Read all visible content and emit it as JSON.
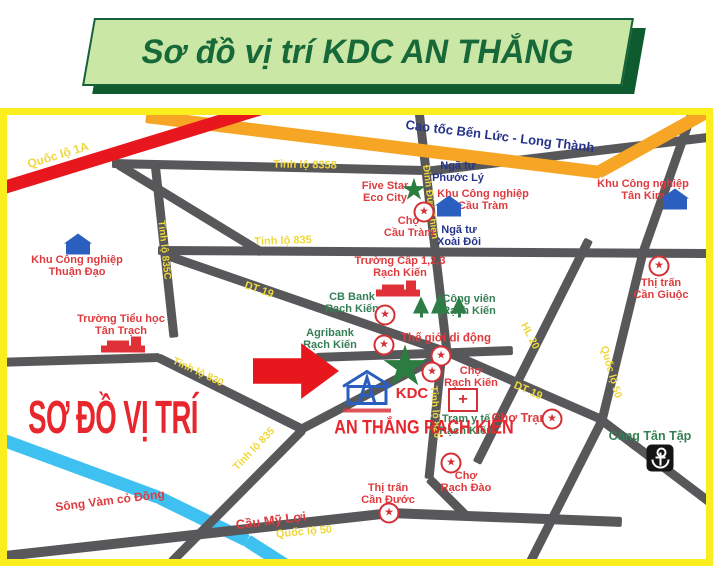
{
  "banner": {
    "title": "Sơ đồ vị trí KDC AN THẮNG"
  },
  "palette": {
    "gray": "#58585A",
    "orange": "#F6A624",
    "red": "#E8161D",
    "river": "#3EC1F0",
    "yellow": "#EFD83C",
    "navy": "#26348B",
    "poired": "#DF3B3E",
    "poigreen": "#357F55",
    "kdcred": "#E8262D",
    "frame_yellow": "#FAEE1E",
    "banner_green": "#CBE7A5",
    "banner_dark": "#0E5B30"
  },
  "map": {
    "watermark": "SƠ ĐỒ VỊ TRÍ",
    "river_segments": [
      {
        "id": "song-vam-co-dong-1",
        "x1": -4,
        "y1": 437,
        "x2": 159,
        "y2": 497,
        "w": 13,
        "c": "river"
      },
      {
        "id": "song-vam-co-dong-2",
        "x1": 159,
        "y1": 497,
        "x2": 247,
        "y2": 540,
        "w": 13,
        "c": "river"
      },
      {
        "id": "song-vam-co-dong-3",
        "x1": 247,
        "y1": 540,
        "x2": 294,
        "y2": 570,
        "w": 13,
        "c": "river"
      }
    ],
    "road_segments": [
      {
        "id": "tinh-lo-8358-w",
        "x1": 112,
        "y1": 163,
        "x2": 427,
        "y2": 170,
        "w": 9,
        "c": "gray"
      },
      {
        "id": "tinh-lo-8358-e",
        "x1": 425,
        "y1": 171,
        "x2": 716,
        "y2": 136,
        "w": 9,
        "c": "gray"
      },
      {
        "id": "nhanh-ql1a",
        "x1": 118,
        "y1": 164,
        "x2": 262,
        "y2": 252,
        "w": 9,
        "c": "gray"
      },
      {
        "id": "tinh-lo-835c",
        "x1": 155,
        "y1": 162,
        "x2": 174,
        "y2": 337,
        "w": 9,
        "c": "gray"
      },
      {
        "id": "tinh-lo-835",
        "x1": 158,
        "y1": 250,
        "x2": 716,
        "y2": 253,
        "w": 9,
        "c": "gray"
      },
      {
        "id": "dinh-duc-thien",
        "x1": 419,
        "y1": 110,
        "x2": 447,
        "y2": 352,
        "w": 9,
        "c": "gray"
      },
      {
        "id": "tinh-lo-830-w",
        "x1": -4,
        "y1": 362,
        "x2": 160,
        "y2": 357,
        "w": 9,
        "c": "gray"
      },
      {
        "id": "tinh-lo-830-e",
        "x1": 158,
        "y1": 357,
        "x2": 303,
        "y2": 429,
        "w": 9,
        "c": "gray"
      },
      {
        "id": "tinh-lo-835-sw",
        "x1": 303,
        "y1": 429,
        "x2": 171,
        "y2": 562,
        "w": 9,
        "c": "gray"
      },
      {
        "id": "duong-vao-kdc",
        "x1": 297,
        "y1": 431,
        "x2": 449,
        "y2": 351,
        "w": 9,
        "c": "gray"
      },
      {
        "id": "dt-19-tay",
        "x1": 167,
        "y1": 255,
        "x2": 448,
        "y2": 352,
        "w": 9,
        "c": "gray"
      },
      {
        "id": "kdc-ngang",
        "x1": 316,
        "y1": 357,
        "x2": 513,
        "y2": 350,
        "w": 9,
        "c": "gray"
      },
      {
        "id": "dt-19-dong",
        "x1": 448,
        "y1": 352,
        "x2": 604,
        "y2": 420,
        "w": 9,
        "c": "gray"
      },
      {
        "id": "tinh-lo-826",
        "x1": 442,
        "y1": 351,
        "x2": 429,
        "y2": 478,
        "w": 9,
        "c": "gray"
      },
      {
        "id": "tinh-lo-826-s",
        "x1": 429,
        "y1": 478,
        "x2": 466,
        "y2": 515,
        "w": 9,
        "c": "gray"
      },
      {
        "id": "hl-20",
        "x1": 589,
        "y1": 239,
        "x2": 477,
        "y2": 462,
        "w": 9,
        "c": "gray"
      },
      {
        "id": "ql-50-bac",
        "x1": 693,
        "y1": 110,
        "x2": 643,
        "y2": 252,
        "w": 9,
        "c": "gray"
      },
      {
        "id": "ql-50-giua",
        "x1": 643,
        "y1": 252,
        "x2": 602,
        "y2": 420,
        "w": 9,
        "c": "gray"
      },
      {
        "id": "ql-50-nam",
        "x1": 602,
        "y1": 420,
        "x2": 528,
        "y2": 566,
        "w": 9,
        "c": "gray"
      },
      {
        "id": "duong-tan-tap",
        "x1": 602,
        "y1": 420,
        "x2": 718,
        "y2": 508,
        "w": 9,
        "c": "gray"
      },
      {
        "id": "ql-50-day-tay",
        "x1": -4,
        "y1": 557,
        "x2": 391,
        "y2": 513,
        "w": 10,
        "c": "gray"
      },
      {
        "id": "ql-50-day-dong",
        "x1": 391,
        "y1": 513,
        "x2": 622,
        "y2": 522,
        "w": 10,
        "c": "gray"
      },
      {
        "id": "cao-toc-1",
        "x1": 146,
        "y1": 116,
        "x2": 601,
        "y2": 172,
        "w": 13,
        "c": "orange"
      },
      {
        "id": "cao-toc-2",
        "x1": 598,
        "y1": 172,
        "x2": 715,
        "y2": 107,
        "w": 13,
        "c": "orange"
      },
      {
        "id": "quoc-lo-1a",
        "x1": -6,
        "y1": 190,
        "x2": 268,
        "y2": 106,
        "w": 13,
        "c": "red"
      }
    ],
    "road_labels": [
      {
        "id": "quoc-lo-1a",
        "text": "Quốc lộ 1A",
        "x": 58,
        "y": 155,
        "rot": -17,
        "c": "yellow",
        "s": 12
      },
      {
        "id": "tinh-lo-8358",
        "text": "Tỉnh lộ 8358",
        "x": 305,
        "y": 165,
        "rot": 1,
        "c": "yellow",
        "s": 11
      },
      {
        "id": "tinh-lo-835",
        "text": "Tỉnh lộ 835",
        "x": 283,
        "y": 241,
        "rot": -2,
        "c": "yellow",
        "s": 11
      },
      {
        "id": "tinh-lo-835c",
        "text": "Tỉnh lộ 835C",
        "x": 164,
        "y": 250,
        "rot": 84,
        "c": "yellow",
        "s": 10
      },
      {
        "id": "dinh-duc-thien",
        "text": "Đinh Đức Thiện",
        "x": 430,
        "y": 202,
        "rot": 83,
        "c": "yellow",
        "s": 10
      },
      {
        "id": "dt-19-tay",
        "text": "DT 19",
        "x": 259,
        "y": 290,
        "rot": 19,
        "c": "yellow",
        "s": 11
      },
      {
        "id": "tinh-lo-830",
        "text": "Tỉnh lộ 830",
        "x": 198,
        "y": 372,
        "rot": 25,
        "c": "yellow",
        "s": 10.5
      },
      {
        "id": "tinh-lo-835-sw",
        "text": "Tỉnh lộ 835",
        "x": 254,
        "y": 449,
        "rot": -46,
        "c": "yellow",
        "s": 10.5
      },
      {
        "id": "tinh-lo-826",
        "text": "Tỉnh lộ 826",
        "x": 435,
        "y": 412,
        "rot": 86,
        "c": "yellow",
        "s": 10
      },
      {
        "id": "dt-19-dong",
        "text": "DT 19",
        "x": 528,
        "y": 391,
        "rot": 24,
        "c": "yellow",
        "s": 11
      },
      {
        "id": "hl-20",
        "text": "HL 20",
        "x": 530,
        "y": 336,
        "rot": 63,
        "c": "yellow",
        "s": 10.5
      },
      {
        "id": "quoc-lo-50-dong",
        "text": "Quốc lộ 50",
        "x": 611,
        "y": 372,
        "rot": 74,
        "c": "yellow",
        "s": 10.5
      },
      {
        "id": "quoc-lo-50-nam",
        "text": "Quốc lộ 50",
        "x": 304,
        "y": 532,
        "rot": -5,
        "c": "yellow",
        "s": 11
      },
      {
        "id": "cao-toc-ben-luc",
        "text": "Cao tốc Bến Lức - Long Thành",
        "x": 500,
        "y": 136,
        "rot": 7,
        "c": "navy",
        "s": 13
      }
    ],
    "pois": [
      {
        "id": "kcn-thuan-dao",
        "c": "poired",
        "x": 77,
        "y": 266,
        "lines": [
          "Khu Công nghiệp",
          "Thuận Đạo"
        ]
      },
      {
        "id": "truong-tieu-hoc-tan-trach",
        "c": "poired",
        "x": 121,
        "y": 325,
        "lines": [
          "Trường Tiểu học",
          "Tân Trạch"
        ]
      },
      {
        "id": "five-star-eco-city",
        "c": "poired",
        "x": 385,
        "y": 192,
        "lines": [
          "Five Star",
          "Eco City"
        ]
      },
      {
        "id": "cho-cau-tram",
        "c": "poired",
        "x": 409,
        "y": 227,
        "lines": [
          "Chợ",
          "Cầu Tràm"
        ]
      },
      {
        "id": "kcn-cau-tram",
        "c": "poired",
        "x": 483,
        "y": 200,
        "lines": [
          "Khu Công nghiệp",
          "Cầu Tràm"
        ]
      },
      {
        "id": "nga-tu-phuoc-ly",
        "c": "navy",
        "x": 458,
        "y": 172,
        "lines": [
          "Ngã tư",
          "Phước Lý"
        ]
      },
      {
        "id": "nga-tu-xoai-doi",
        "c": "navy",
        "x": 459,
        "y": 236,
        "lines": [
          "Ngã tư",
          "Xoài Đôi"
        ]
      },
      {
        "id": "kcn-tan-kim",
        "c": "poired",
        "x": 643,
        "y": 190,
        "lines": [
          "Khu Công nghiệp",
          "Tân Kim"
        ]
      },
      {
        "id": "thi-tran-can-giuoc",
        "c": "poired",
        "x": 661,
        "y": 289,
        "lines": [
          "Thị trấn",
          "Cần Giuộc"
        ]
      },
      {
        "id": "truong-cap-123-rach-kien",
        "c": "poired",
        "x": 400,
        "y": 267,
        "lines": [
          "Trường Cấp 1,2,3",
          "Rạch Kiến"
        ]
      },
      {
        "id": "cb-bank-rach-kien",
        "c": "poigreen",
        "x": 352,
        "y": 303,
        "lines": [
          "CB Bank",
          "Rạch Kiến"
        ]
      },
      {
        "id": "cong-vien-rach-kien",
        "c": "poigreen",
        "x": 469,
        "y": 305,
        "lines": [
          "Công viên",
          "Rạch Kiến"
        ]
      },
      {
        "id": "agribank-rach-kien",
        "c": "poigreen",
        "x": 330,
        "y": 339,
        "lines": [
          "Agribank",
          "Rạch Kiến"
        ]
      },
      {
        "id": "the-gioi-di-dong",
        "c": "poired",
        "x": 446,
        "y": 339,
        "lines": [
          "Thế giới di động"
        ],
        "s": 11.5
      },
      {
        "id": "cho-rach-kien",
        "c": "poired",
        "x": 471,
        "y": 377,
        "lines": [
          "Chợ",
          "Rạch Kiến"
        ]
      },
      {
        "id": "tram-y-te-rach-kien",
        "c": "poigreen",
        "x": 466,
        "y": 425,
        "lines": [
          "Trạm y tế",
          "Rạch Kiến"
        ]
      },
      {
        "id": "cho-tram",
        "c": "poired",
        "x": 521,
        "y": 419,
        "lines": [
          "Chợ Trạm"
        ],
        "s": 12.5
      },
      {
        "id": "cang-tan-tap",
        "c": "poigreen",
        "x": 650,
        "y": 437,
        "lines": [
          "Cảng Tân Tập"
        ],
        "s": 12.5
      },
      {
        "id": "cho-rach-dao",
        "c": "poired",
        "x": 466,
        "y": 482,
        "lines": [
          "Chợ",
          "Rạch Đào"
        ]
      },
      {
        "id": "thi-tran-can-duoc",
        "c": "poired",
        "x": 388,
        "y": 494,
        "lines": [
          "Thị trấn",
          "Cần Đước"
        ]
      },
      {
        "id": "cau-my-loi",
        "c": "poired",
        "x": 271,
        "y": 521,
        "rot": -7,
        "lines": [
          "Cầu Mỹ Lợi"
        ],
        "s": 13
      },
      {
        "id": "song-vam-co-dong",
        "c": "poired",
        "x": 110,
        "y": 501,
        "rot": -7,
        "lines": [
          "Sông Vàm cỏ Đông"
        ],
        "s": 12
      },
      {
        "id": "kdc-label",
        "c": "kdcred",
        "x": 412,
        "y": 394,
        "lines": [
          "KDC"
        ],
        "s": 15
      },
      {
        "id": "kdc-an-thang-rach-kien",
        "c": "kdcred",
        "x": 424,
        "y": 429,
        "lines": [
          "AN THẮNG RẠCH KIẾN"
        ],
        "s": 19,
        "sx": 0.85
      }
    ],
    "icons": [
      {
        "id": "kcn-thuan-dao",
        "t": "building",
        "x": 78,
        "y": 244
      },
      {
        "id": "kcn-cau-tram",
        "t": "building",
        "x": 449,
        "y": 206
      },
      {
        "id": "kcn-tan-kim",
        "t": "building",
        "x": 675,
        "y": 199
      },
      {
        "id": "truong-tan-trach",
        "t": "school",
        "x": 123,
        "y": 344
      },
      {
        "id": "truong-rach-kien",
        "t": "school",
        "x": 398,
        "y": 288
      },
      {
        "id": "cho-cau-tram",
        "t": "medal",
        "x": 424,
        "y": 212
      },
      {
        "id": "thi-tran-can-giuoc",
        "t": "medal",
        "x": 659,
        "y": 266
      },
      {
        "id": "cb-bank",
        "t": "medal",
        "x": 385,
        "y": 315
      },
      {
        "id": "the-gioi-di-dong-1",
        "t": "medal",
        "x": 384,
        "y": 345
      },
      {
        "id": "the-gioi-di-dong-2",
        "t": "medal",
        "x": 441,
        "y": 356
      },
      {
        "id": "cho-rach-kien",
        "t": "medal",
        "x": 432,
        "y": 372
      },
      {
        "id": "cho-tram",
        "t": "medal",
        "x": 552,
        "y": 419
      },
      {
        "id": "cho-rach-dao",
        "t": "medal",
        "x": 451,
        "y": 463
      },
      {
        "id": "thi-tran-can-duoc",
        "t": "medal",
        "x": 389,
        "y": 513
      },
      {
        "id": "five-star",
        "t": "green-star",
        "x": 414,
        "y": 190,
        "s": 30
      },
      {
        "id": "kdc-marker",
        "t": "green-star",
        "x": 405,
        "y": 366,
        "s": 56
      },
      {
        "id": "cong-vien",
        "t": "trees",
        "x": 440,
        "y": 305
      },
      {
        "id": "tram-y-te",
        "t": "cross",
        "x": 463,
        "y": 400
      },
      {
        "id": "cang-tan-tap",
        "t": "anchor",
        "x": 660,
        "y": 458
      },
      {
        "id": "kdc-logo",
        "t": "house",
        "x": 367,
        "y": 390
      },
      {
        "id": "kdc-pointer",
        "t": "arrow",
        "x": 296,
        "y": 371
      }
    ]
  }
}
